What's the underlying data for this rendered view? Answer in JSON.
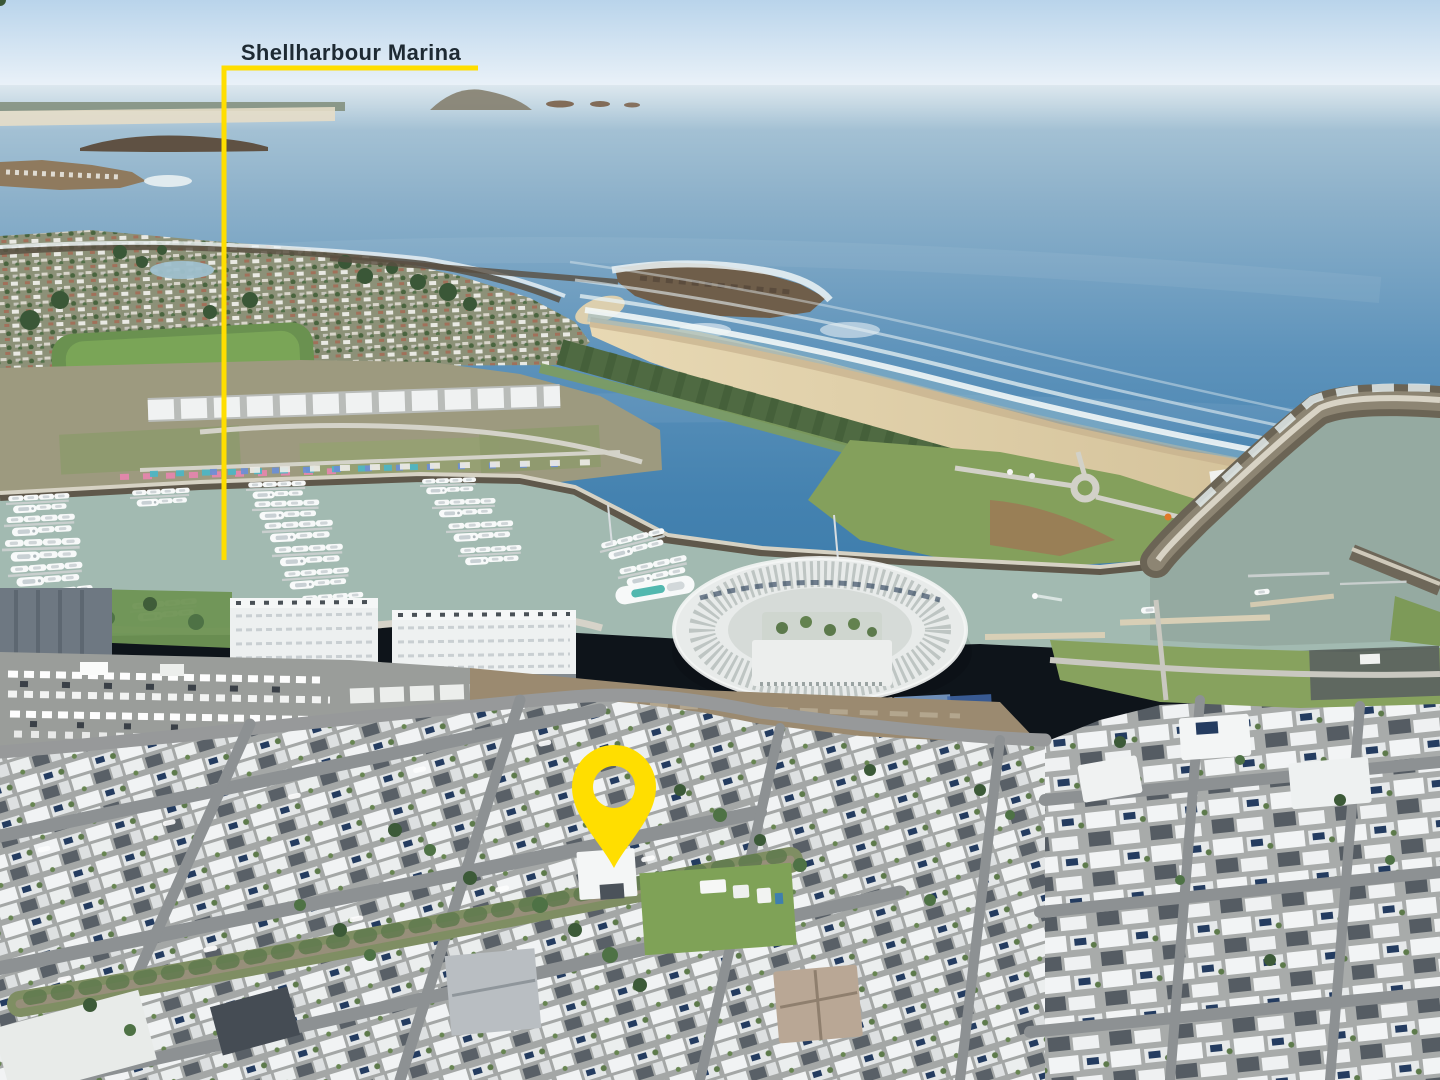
{
  "annotation": {
    "label": "Shellharbour Marina",
    "label_color": "#1e2a33",
    "line_color": "#FFDE00",
    "pin_color": "#FFDE00"
  },
  "scene": {
    "palette": {
      "sky": "#bcd6ec",
      "ocean_deep": "#3d7cab",
      "ocean_far": "#9fbcd0",
      "surf": "#eef4f6",
      "sand": "#ddcda9",
      "marina_water": "#a2bab1",
      "channel_water": "#93a8a0",
      "rock_breakwater": "#6e6455",
      "grass": "#7ba356",
      "dune_vegetation": "#4f6a42",
      "roof_white": "#f1f3f4",
      "roof_dark": "#565d64",
      "solar_panel": "#243c60",
      "asphalt": "#97999b"
    }
  }
}
